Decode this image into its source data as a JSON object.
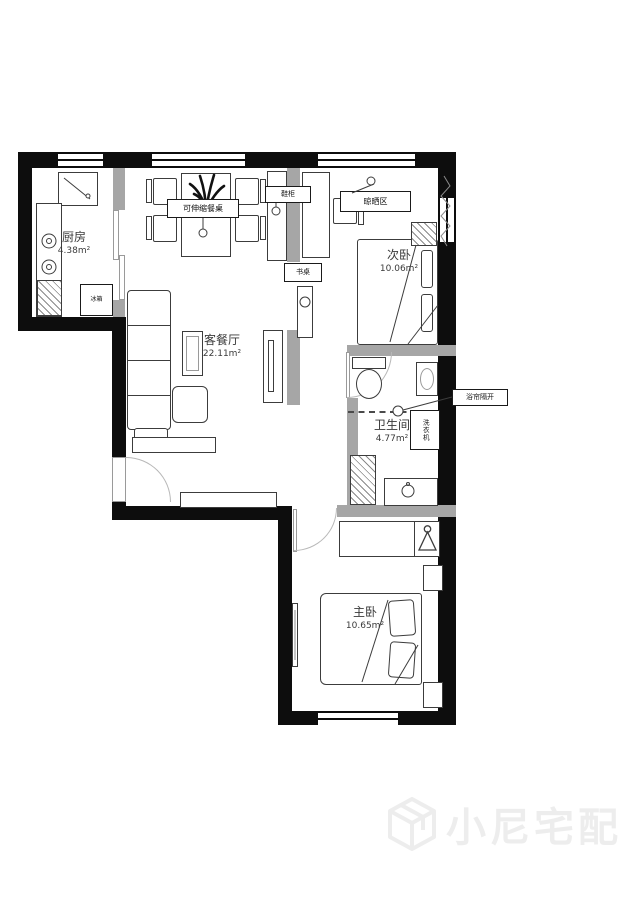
{
  "watermark": {
    "text": "小尼宅配"
  },
  "rooms": {
    "kitchen": {
      "name": "厨房",
      "area": "4.38m²"
    },
    "living": {
      "name": "客餐厅",
      "area": "22.11m²"
    },
    "second_bedroom": {
      "name": "次卧",
      "area": "10.06m²"
    },
    "bathroom": {
      "name": "卫生间",
      "area": "4.77m²"
    },
    "master_bedroom": {
      "name": "主卧",
      "area": "10.65m²"
    }
  },
  "annotations": {
    "extendable_dining_table": "可伸缩餐桌",
    "shoe_cabinet": "鞋柜",
    "desk": "书桌",
    "drying_area": "晾晒区",
    "shower_curtain_divider": "浴帘隔开",
    "washing_machine": "洗衣机",
    "fridge": "冰箱"
  },
  "colors": {
    "wall": "#0d0d0d",
    "partition": "#a6a6a6",
    "line": "#3c3c3c",
    "watermark": "#ededed"
  }
}
